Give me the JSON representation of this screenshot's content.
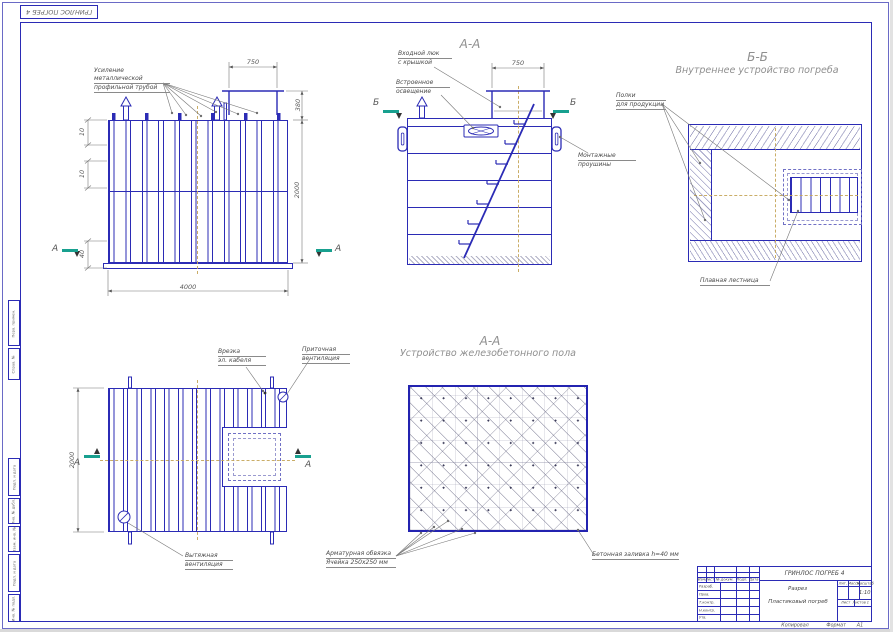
{
  "sheet": {
    "corner_stamp": "ГРИНЛОС ПОГРЕБ 4",
    "margin_cells": [
      "Перв. примен.",
      "Справ. №",
      "Подп. и дата",
      "Инв. № дубл.",
      "Взам. инв. №",
      "Подп. и дата",
      "Инв. № подл."
    ],
    "footer": {
      "copied": "Копировал",
      "format_label": "Формат",
      "format_value": "А1"
    }
  },
  "front_view": {
    "reinforcement_label": [
      "Усиление металлической",
      "профильной трубой"
    ],
    "dims": {
      "chimney_width": "750",
      "chimney_height": "380",
      "body_height": "2000",
      "body_width": "4000",
      "left_top": "10",
      "left_mid": "10",
      "left_bottom": "40"
    },
    "section_letter": "А"
  },
  "section_aa": {
    "title": "А-А",
    "hatch_label": [
      "Входной люк",
      "с крышкой"
    ],
    "light_label": [
      "Встроенное",
      "освещение"
    ],
    "lugs_label": [
      "Монтажные",
      "проушины"
    ],
    "dims": {
      "chimney_width": "750"
    },
    "section_letter": "Б"
  },
  "section_bb": {
    "title": "Б-Б",
    "subtitle": "Внутреннее устройство погреба",
    "shelves_label": [
      "Полки",
      "для продукции"
    ],
    "ladder_label": "Плавная лестница"
  },
  "plan_view": {
    "cable_label": [
      "Врезка",
      "эл. кабеля"
    ],
    "supply_vent_label": [
      "Приточная",
      "вентиляция"
    ],
    "exhaust_vent_label": [
      "Вытяжная",
      "вентиляция"
    ],
    "dims": {
      "body_depth": "2000"
    },
    "section_letter": "А"
  },
  "floor_view": {
    "title": "А-А",
    "subtitle": "Устройство железобетонного пола",
    "rebar_label": [
      "Арматурная обвязка",
      "Ячейка 250х250 мм"
    ],
    "concrete_label": "Бетонная заливка h=40 мм"
  },
  "title_block": {
    "doc_title": "ГРИНЛОС ПОГРЕБ 4",
    "doc_type": "Разрез",
    "doc_name": "Пластиковый погреб",
    "scale_value": "1:10",
    "col_headers": [
      "Изм.",
      "Лист",
      "№ докум.",
      "Подп.",
      "Дата"
    ],
    "row_labels": [
      "Разраб.",
      "Пров.",
      "Т.контр.",
      "Н.контр.",
      "Утв."
    ],
    "lit_label": "Лит.",
    "mass_label": "Масса",
    "scale_label": "Масштаб",
    "sheet_label": "Лист",
    "sheets_label": "Листов",
    "sheets_value": "1"
  }
}
